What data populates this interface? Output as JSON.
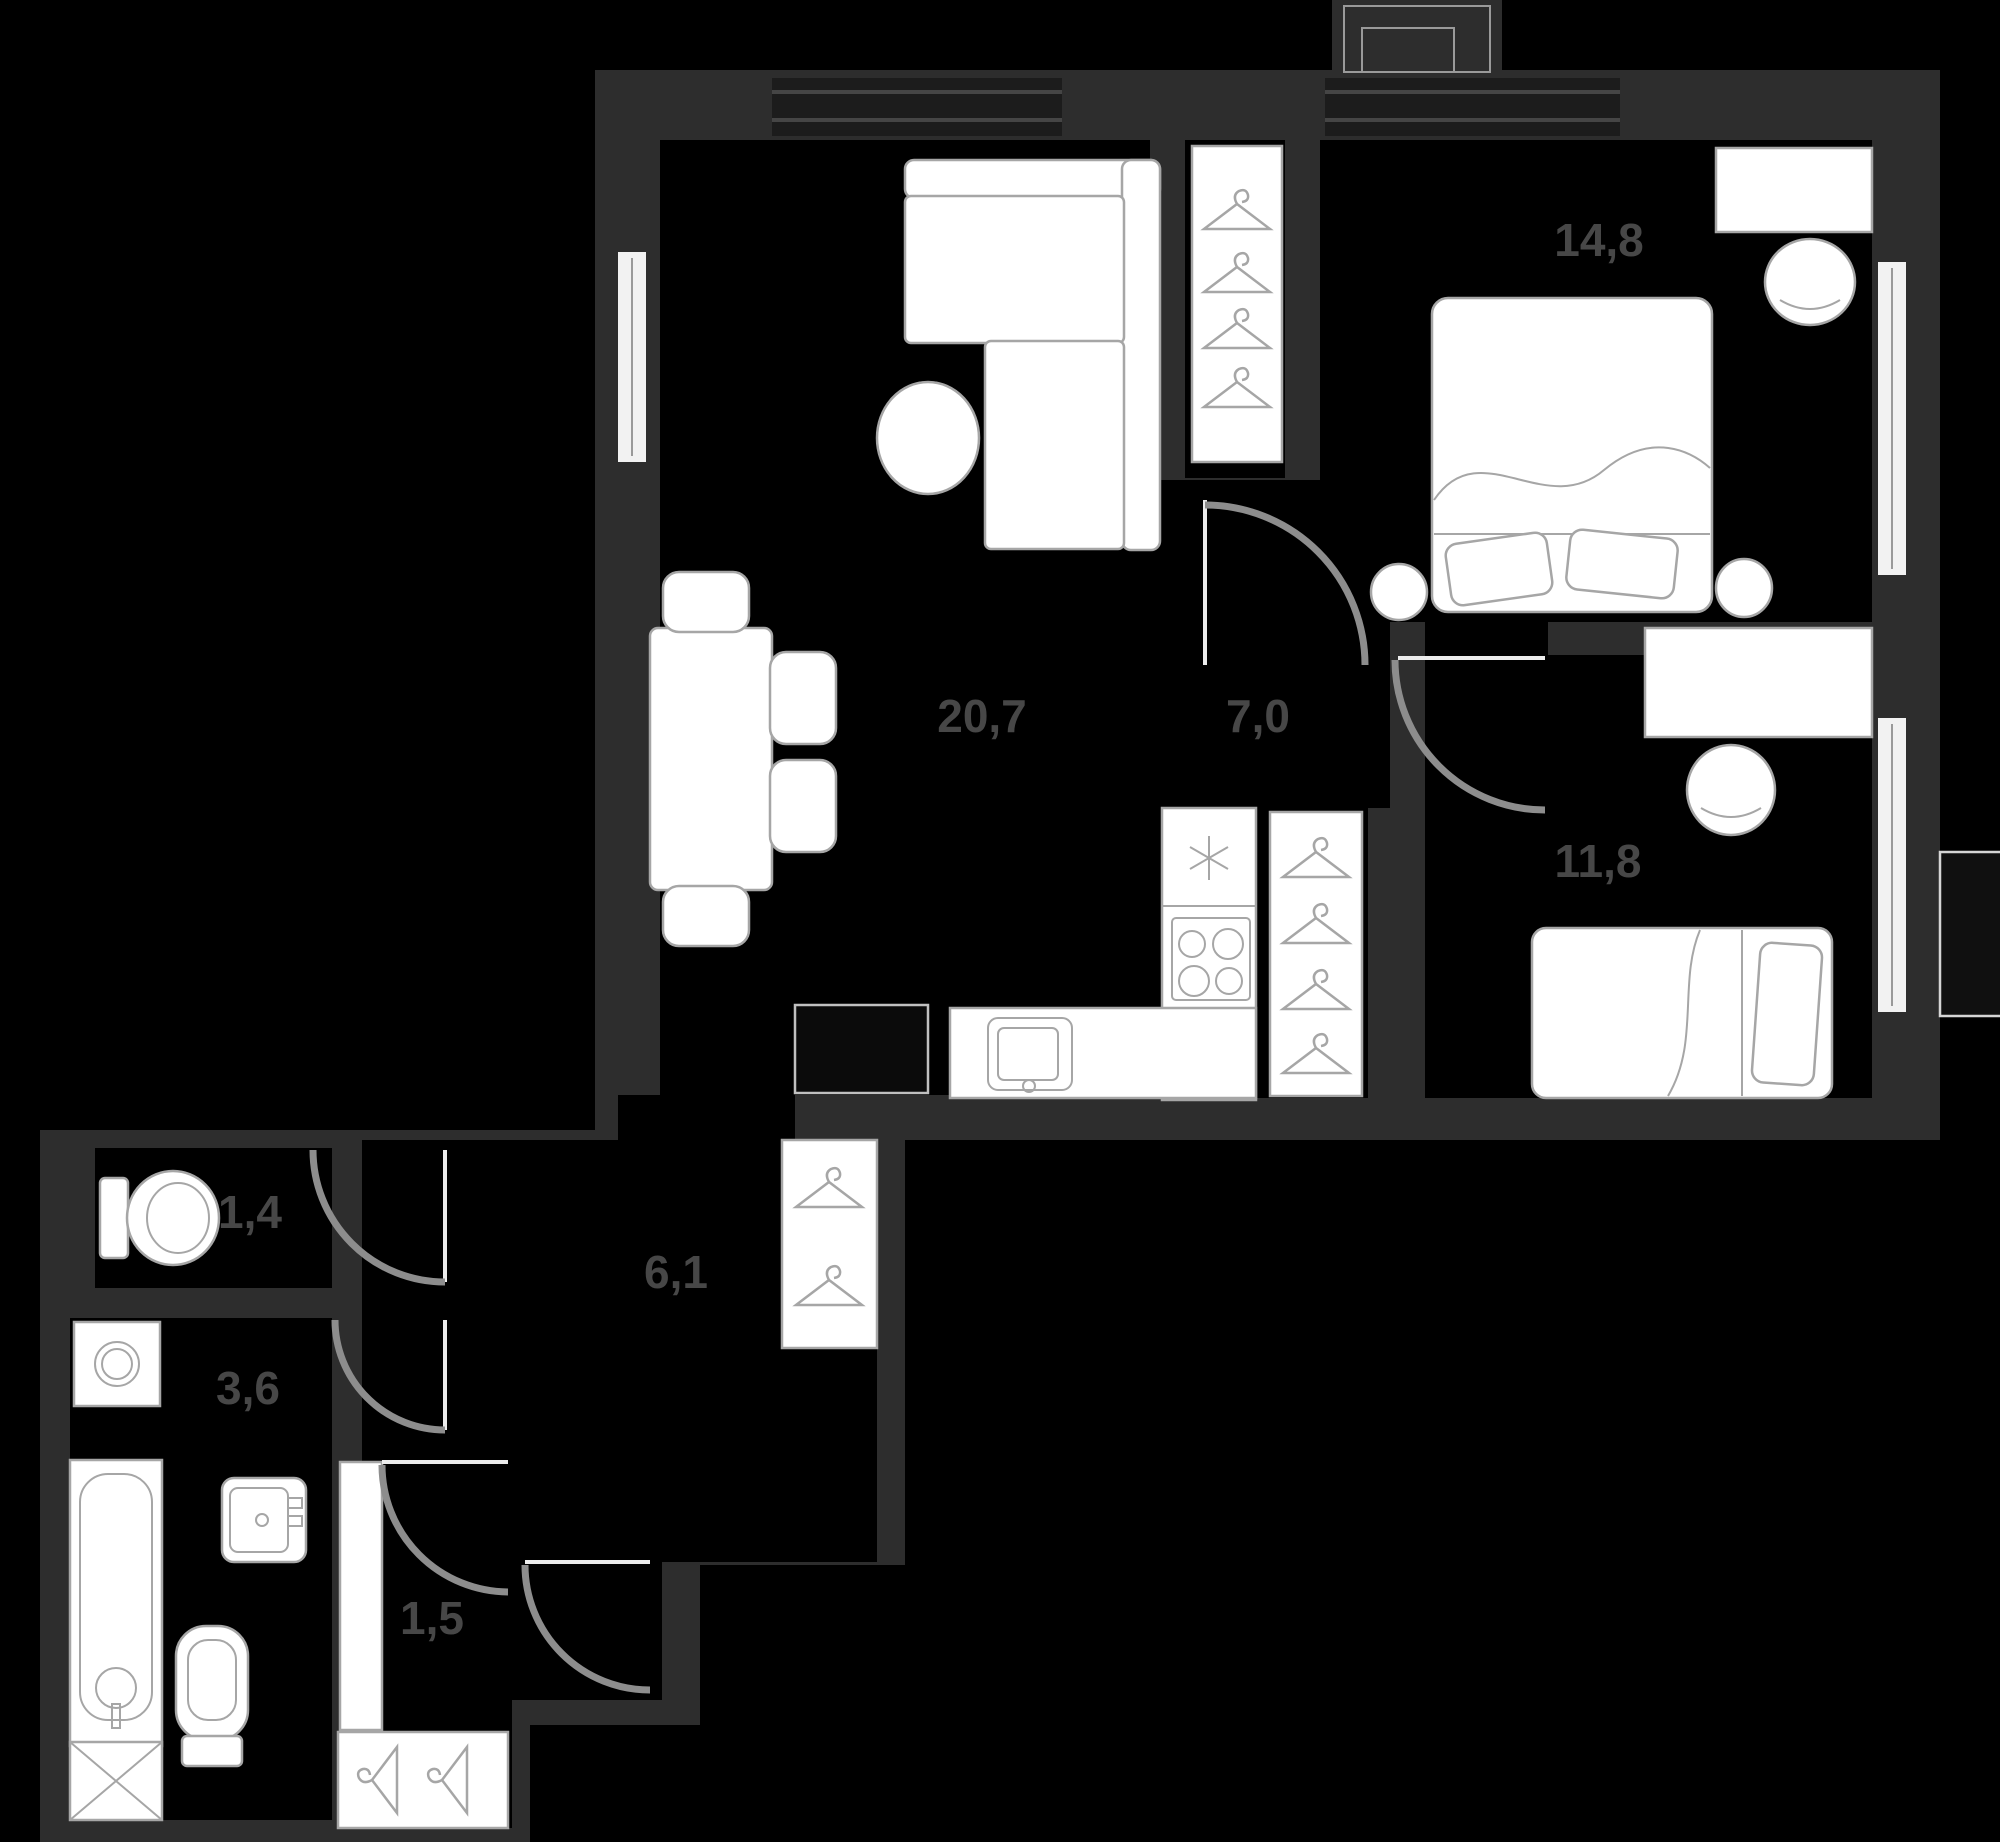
{
  "plan": {
    "title": "apartment-floor-plan",
    "colors": {
      "bg": "#000000",
      "wall": "#2d2d2d",
      "furn_fill": "#ffffff",
      "furn_stroke": "#a6a6a6",
      "door_arc": "#8d8d8d",
      "label": "#474747",
      "window_dark": "#1c1c1c",
      "window_light": "#f2f2f2",
      "appliance_stroke": "#c0c0c0"
    },
    "rooms": [
      {
        "id": "living-kitchen",
        "area_label": "20,7"
      },
      {
        "id": "hallway",
        "area_label": "7,0"
      },
      {
        "id": "bedroom-1",
        "area_label": "14,8"
      },
      {
        "id": "bedroom-2",
        "area_label": "11,8"
      },
      {
        "id": "corridor",
        "area_label": "6,1"
      },
      {
        "id": "wc",
        "area_label": "1,4"
      },
      {
        "id": "bathroom",
        "area_label": "3,6"
      },
      {
        "id": "closet",
        "area_label": "1,5"
      }
    ],
    "icons": [
      "hanger-icon",
      "fridge-asterisk-icon",
      "stove-burners-icon",
      "sink-icon",
      "toilet-icon",
      "bathtub-icon",
      "washing-machine-icon",
      "door-swing-arc",
      "window-symbol",
      "bed-icon",
      "sofa-icon",
      "desk-chair-icon"
    ]
  }
}
